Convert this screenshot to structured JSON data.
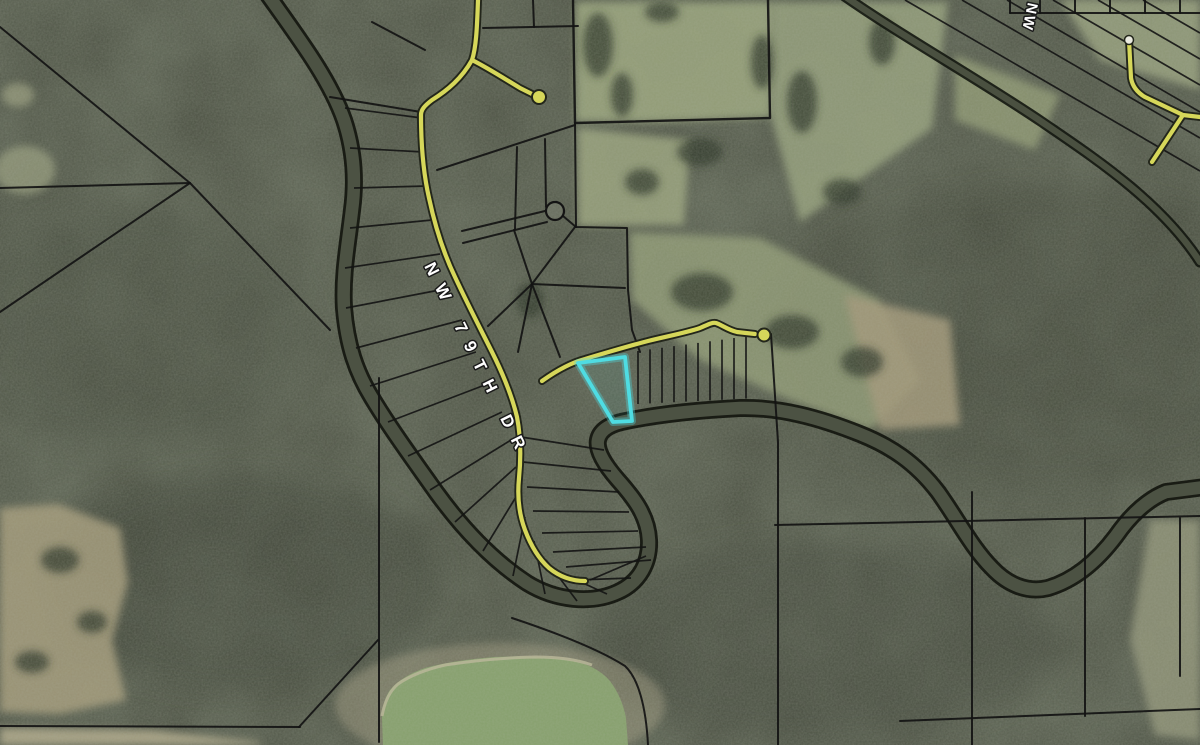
{
  "map": {
    "labels": {
      "main_road": "NW 79TH DR",
      "corner_road": "NW"
    },
    "colors": {
      "parcel_line": "#141414",
      "road_fill": "#d6d75a",
      "road_casing": "#23261b",
      "highlight": "#4fdce2",
      "forest": "#4b5042",
      "field": "#a3a483",
      "pond": "#86a06c",
      "river": "#4c5243",
      "label_text": "#ffffff",
      "label_outline": "#1a1a1a"
    }
  }
}
